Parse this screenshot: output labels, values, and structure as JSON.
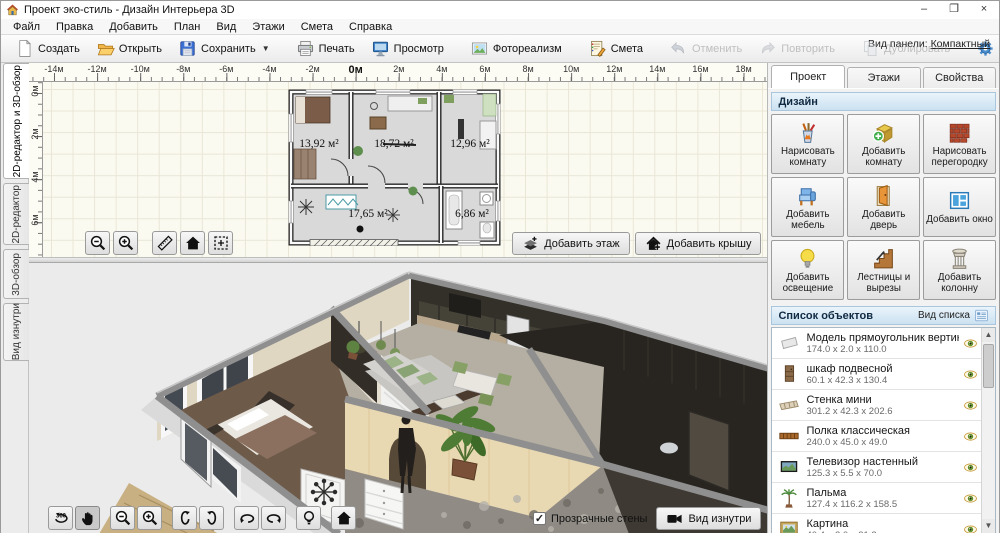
{
  "window": {
    "title": "Проект эко-стиль - Дизайн Интерьера 3D",
    "controls": {
      "minimize": "–",
      "maximize": "❐",
      "close": "×"
    }
  },
  "menu": {
    "items": [
      "Файл",
      "Правка",
      "Добавить",
      "План",
      "Вид",
      "Этажи",
      "Смета",
      "Справка"
    ]
  },
  "toolbar": {
    "buttons": [
      {
        "id": "new",
        "label": "Создать",
        "icon": "new-document",
        "enabled": true
      },
      {
        "id": "open",
        "label": "Открыть",
        "icon": "open-folder",
        "enabled": true
      },
      {
        "id": "save",
        "label": "Сохранить",
        "icon": "save-floppy",
        "enabled": true,
        "dropdown": true
      },
      {
        "id": "print",
        "label": "Печать",
        "icon": "printer",
        "enabled": true,
        "sep_before": true
      },
      {
        "id": "preview",
        "label": "Просмотр",
        "icon": "monitor",
        "enabled": true
      },
      {
        "id": "photorealism",
        "label": "Фотореализм",
        "icon": "photo",
        "enabled": true,
        "sep_before": true
      },
      {
        "id": "estimate",
        "label": "Смета",
        "icon": "estimate",
        "enabled": true,
        "sep_before": true
      },
      {
        "id": "undo",
        "label": "Отменить",
        "icon": "undo",
        "enabled": false,
        "sep_before": true
      },
      {
        "id": "redo",
        "label": "Повторить",
        "icon": "redo",
        "enabled": false
      },
      {
        "id": "duplicate",
        "label": "Дублировать",
        "icon": "duplicate",
        "enabled": false,
        "sep_before": true
      },
      {
        "id": "settings",
        "label": "",
        "icon": "gear",
        "enabled": true,
        "sep_before": true
      },
      {
        "id": "help",
        "label": "",
        "icon": "help",
        "enabled": true
      }
    ],
    "panel_view_label": "Вид панели:",
    "panel_view_value": "Компактный"
  },
  "left_tabs": [
    {
      "label": "2D-редактор и 3D-обзор",
      "active": true
    },
    {
      "label": "2D-редактор",
      "active": false
    },
    {
      "label": "3D-обзор",
      "active": false
    },
    {
      "label": "Вид изнутри",
      "active": false
    }
  ],
  "editor2d": {
    "ruler_h": [
      "-14м",
      "-12м",
      "-10м",
      "-8м",
      "-6м",
      "-4м",
      "-2м",
      "0м",
      "2м",
      "4м",
      "6м",
      "8м",
      "10м",
      "12м",
      "14м",
      "16м",
      "18м"
    ],
    "ruler_v": [
      "0м",
      "2м",
      "4м",
      "6м",
      "8м"
    ],
    "rooms": [
      {
        "area": "13,92 м²",
        "x": 31,
        "y": 58
      },
      {
        "area": "18,72 м²",
        "x": 106,
        "y": 58
      },
      {
        "area": "12,96 м²",
        "x": 182,
        "y": 58
      },
      {
        "area": "17,65 м²",
        "x": 80,
        "y": 128
      },
      {
        "area": "6,86 м²",
        "x": 184,
        "y": 128
      }
    ],
    "tools": [
      {
        "icon": "zoom-out"
      },
      {
        "icon": "zoom-in",
        "gap_after": true
      },
      {
        "icon": "measure"
      },
      {
        "icon": "home"
      },
      {
        "icon": "select-area"
      }
    ],
    "floor_buttons": [
      {
        "label": "Добавить этаж",
        "icon": "add-floor"
      },
      {
        "label": "Добавить крышу",
        "icon": "add-roof"
      }
    ]
  },
  "viewer3d": {
    "tools": [
      {
        "icon": "rotate-360"
      },
      {
        "icon": "pan-hand",
        "pressed": true,
        "gap_after": true
      },
      {
        "icon": "zoom-out"
      },
      {
        "icon": "zoom-in",
        "gap_after": true
      },
      {
        "icon": "orbit-up"
      },
      {
        "icon": "orbit-down",
        "gap_after": true
      },
      {
        "icon": "orbit-left"
      },
      {
        "icon": "orbit-right",
        "gap_after": true
      },
      {
        "icon": "light-bulb",
        "gap_after": true
      },
      {
        "icon": "home"
      }
    ],
    "transparent_walls": {
      "label": "Прозрачные стены",
      "checked": true,
      "check_glyph": "✓"
    },
    "inside_view": {
      "label": "Вид изнутри",
      "icon": "camera"
    }
  },
  "right_panel": {
    "tabs": [
      {
        "label": "Проект",
        "active": true
      },
      {
        "label": "Этажи",
        "active": false
      },
      {
        "label": "Свойства",
        "active": false
      }
    ],
    "design": {
      "title": "Дизайн",
      "buttons": [
        {
          "label": "Нарисовать комнату",
          "icon": "draw-room"
        },
        {
          "label": "Добавить комнату",
          "icon": "add-room"
        },
        {
          "label": "Нарисовать перегородку",
          "icon": "draw-partition"
        },
        {
          "label": "Добавить мебель",
          "icon": "add-furniture"
        },
        {
          "label": "Добавить дверь",
          "icon": "add-door"
        },
        {
          "label": "Добавить окно",
          "icon": "add-window"
        },
        {
          "label": "Добавить освещение",
          "icon": "add-light"
        },
        {
          "label": "Лестницы и вырезы",
          "icon": "stairs"
        },
        {
          "label": "Добавить колонну",
          "icon": "add-column"
        }
      ]
    },
    "objects": {
      "title": "Список объектов",
      "view_label": "Вид списка",
      "view_icon": "list-view",
      "items": [
        {
          "name": "Модель прямоугольник вертик...",
          "dims": "174.0 x 2.0 x 110.0",
          "icon": "obj-panel"
        },
        {
          "name": "шкаф подвесной",
          "dims": "60.1 x 42.3 x 130.4",
          "icon": "obj-cabinet"
        },
        {
          "name": "Стенка мини",
          "dims": "301.2 x 42.3 x 202.6",
          "icon": "obj-wallunit"
        },
        {
          "name": "Полка классическая",
          "dims": "240.0 x 45.0 x 49.0",
          "icon": "obj-shelf"
        },
        {
          "name": "Телевизор настенный",
          "dims": "125.3 x 5.5 x 70.0",
          "icon": "obj-tv"
        },
        {
          "name": "Пальма",
          "dims": "127.4 x 116.2 x 158.5",
          "icon": "obj-palm"
        },
        {
          "name": "Картина",
          "dims": "40.4 x 2.0 x 31.2",
          "icon": "obj-picture"
        }
      ]
    }
  },
  "colors": {
    "accent_blue": "#3f8ed6",
    "header_gradient_top": "#eaf4fb",
    "header_gradient_bottom": "#cbe1f1",
    "canvas_bg": "#fbfaf0",
    "viewer_bg": "#ececec"
  }
}
